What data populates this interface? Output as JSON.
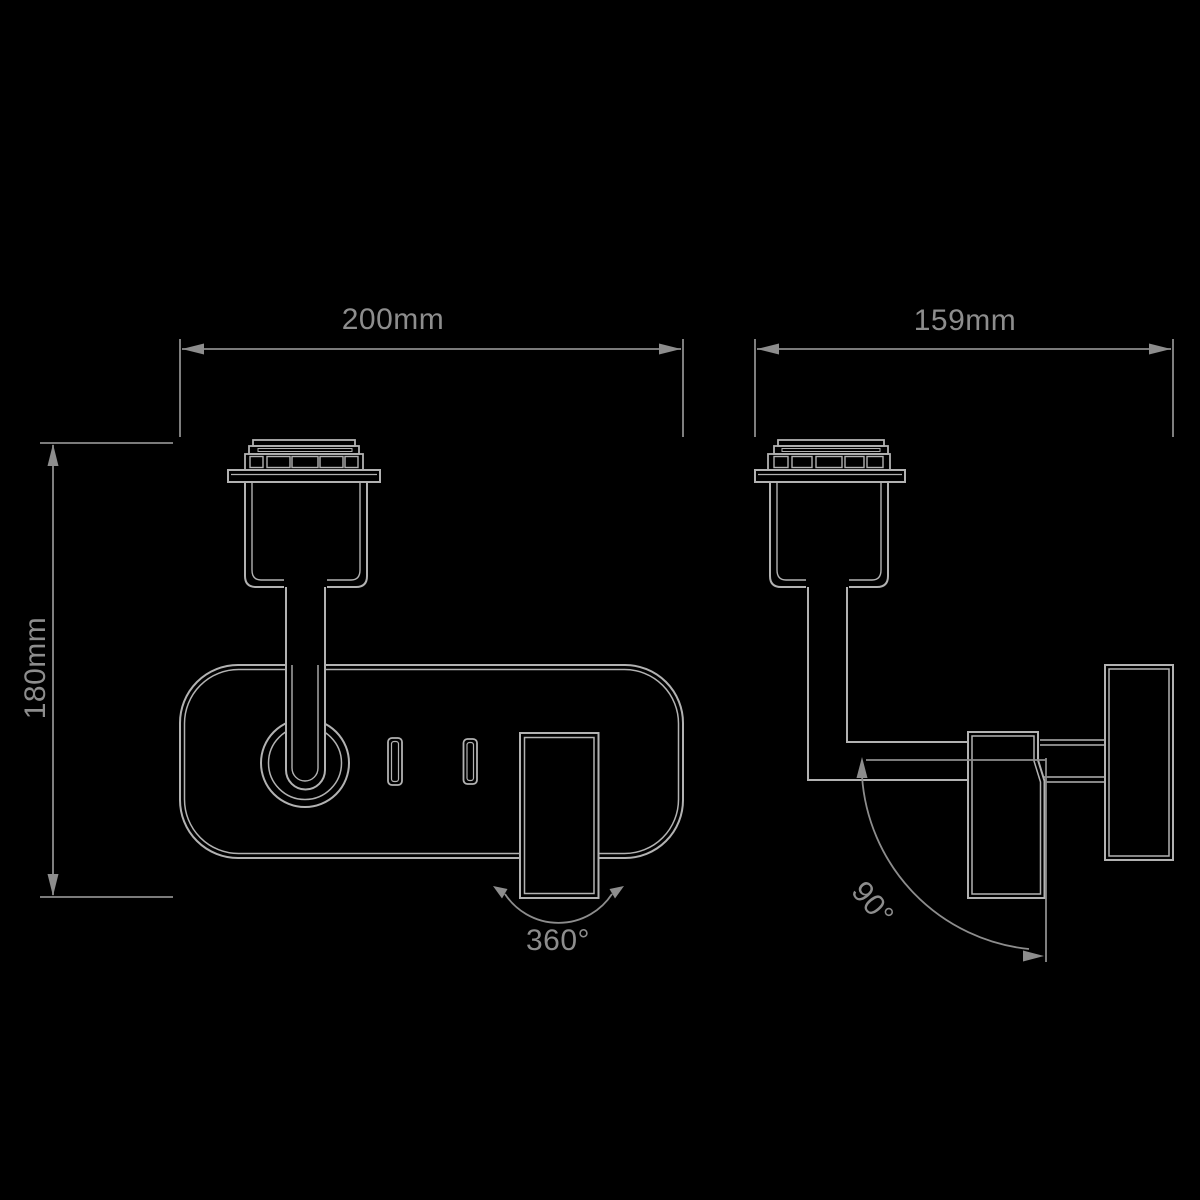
{
  "drawing_type": "technical-dimension-drawing",
  "subject": "wall-mounted spotlight, front and side elevation",
  "colors": {
    "background": "#000000",
    "fixture_line": "#b2b2b2",
    "dimension_line": "#8d8d8d",
    "label_text": "#8d8d8d"
  },
  "dimensions": {
    "front_width": "200mm",
    "front_height": "180mm",
    "side_depth": "159mm",
    "head_rotation": "360°",
    "arm_rotation": "90°"
  }
}
